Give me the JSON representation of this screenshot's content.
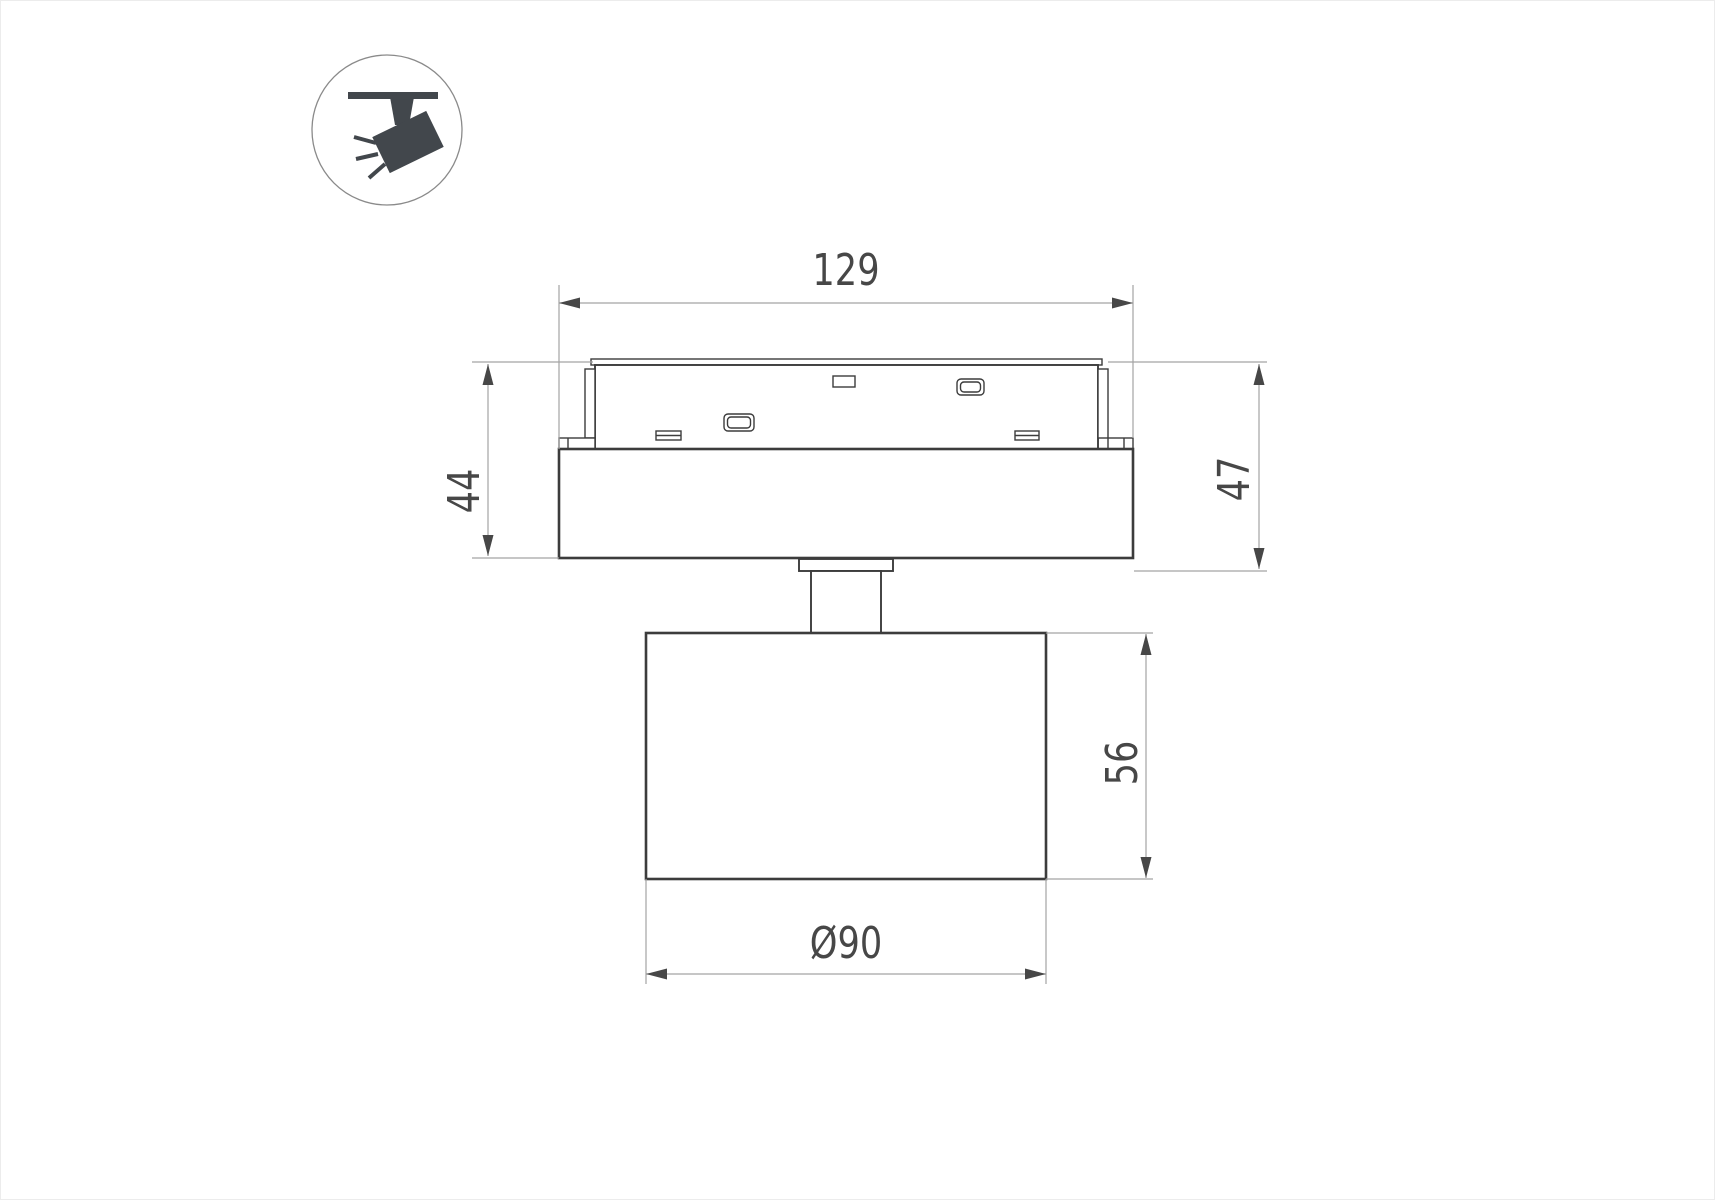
{
  "page": {
    "background": "#ffffff",
    "frame_color": "#ececec"
  },
  "icon": {
    "name": "track-spotlight-pictogram",
    "shape_color": "#42474c",
    "ring_color": "#8a8a8a"
  },
  "drawing": {
    "object_line_color": "#3c3c3c",
    "dimension_line_color": "#a3a3a3",
    "dimension_text_color": "#474747",
    "view": "side-view-track-mounted-spotlight",
    "dimensions": {
      "adapter_width": "129",
      "height_to_housing_bottom": "44",
      "height_to_flange_bottom": "47",
      "head_height": "56",
      "head_diameter": "Ø90"
    }
  }
}
